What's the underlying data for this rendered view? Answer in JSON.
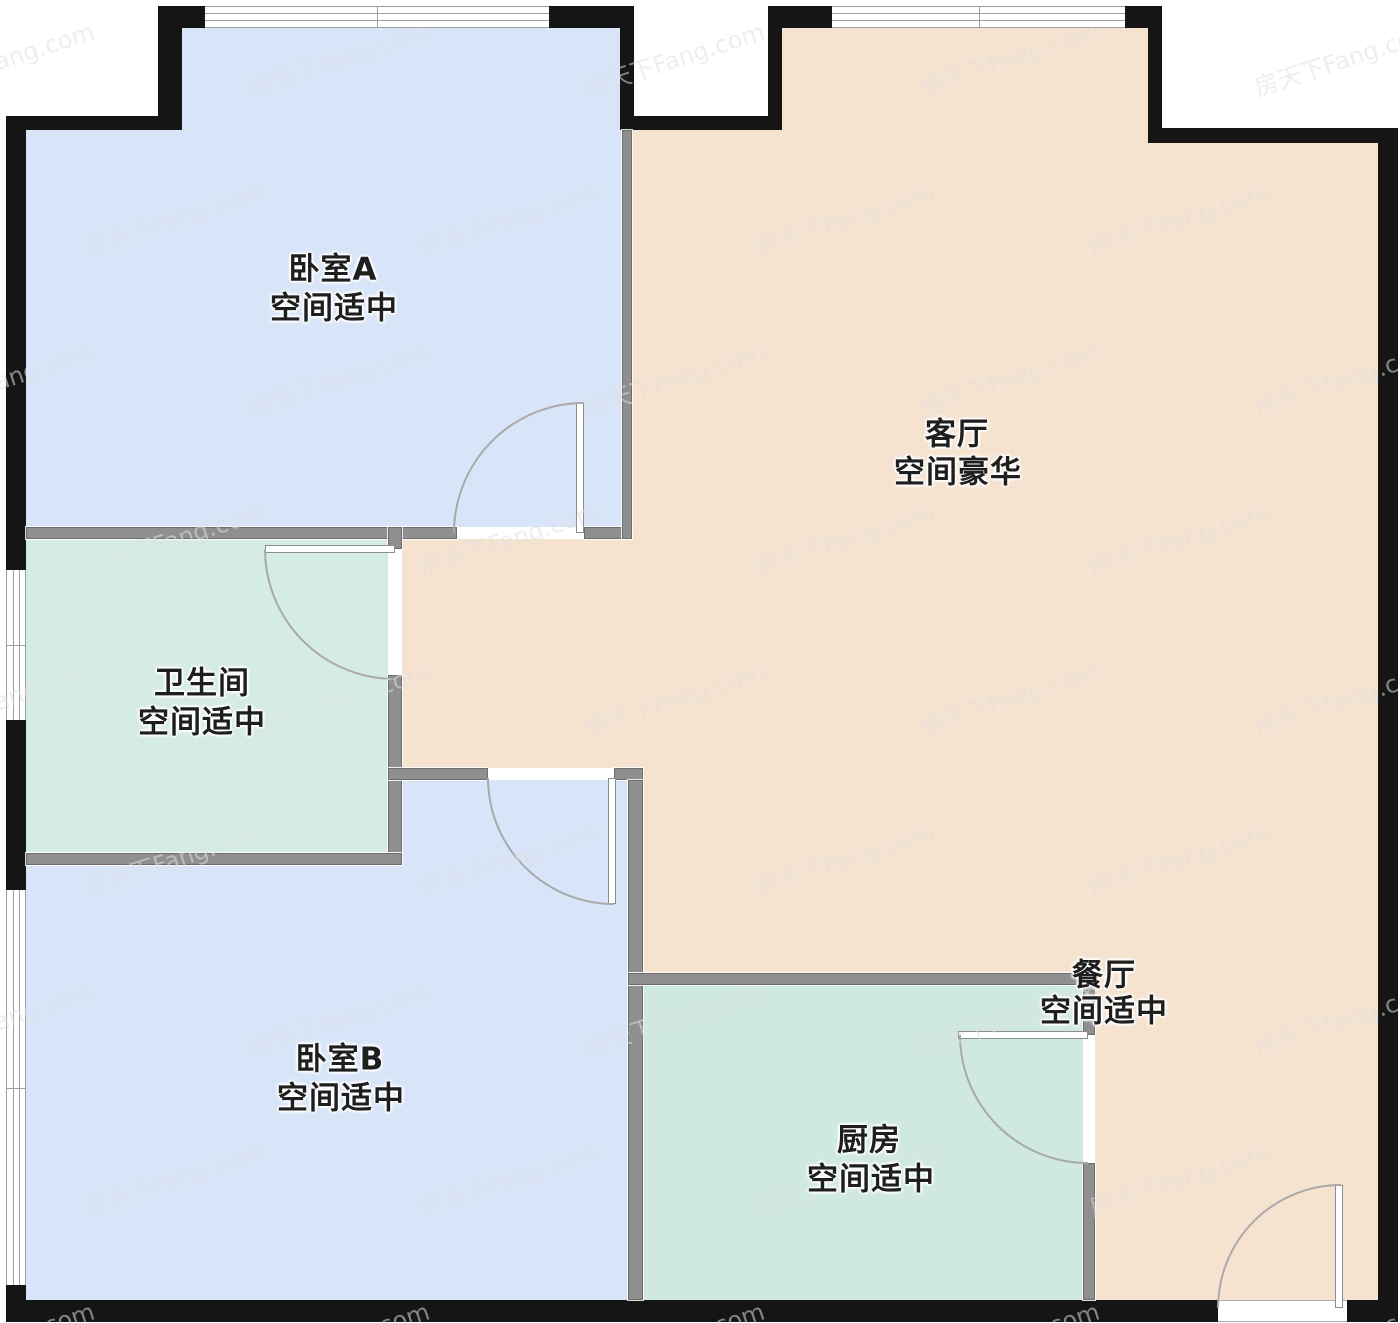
{
  "rooms": [
    {
      "id": "bedroom-a",
      "name": "卧室A",
      "subtitle": "空间适中"
    },
    {
      "id": "living-room",
      "name": "客厅",
      "subtitle": "空间豪华"
    },
    {
      "id": "bathroom",
      "name": "卫生间",
      "subtitle": "空间适中"
    },
    {
      "id": "bedroom-b",
      "name": "卧室B",
      "subtitle": "空间适中"
    },
    {
      "id": "kitchen",
      "name": "厨房",
      "subtitle": "空间适中"
    },
    {
      "id": "dining-room",
      "name": "餐厅",
      "subtitle": "空间适中"
    }
  ],
  "watermark": {
    "text": "房天下Fang.com"
  },
  "colors": {
    "bedroom_fill": "#d8e5f8",
    "living_fill": "#f5e3d0",
    "bathroom_fill": "#d5ece3",
    "kitchen_fill": "#cfe9e1",
    "outer_wall": "#151515",
    "inner_wall": "#8f8f8f",
    "door_arc": "#a9a9a9",
    "window_line": "#9f9f9f"
  }
}
